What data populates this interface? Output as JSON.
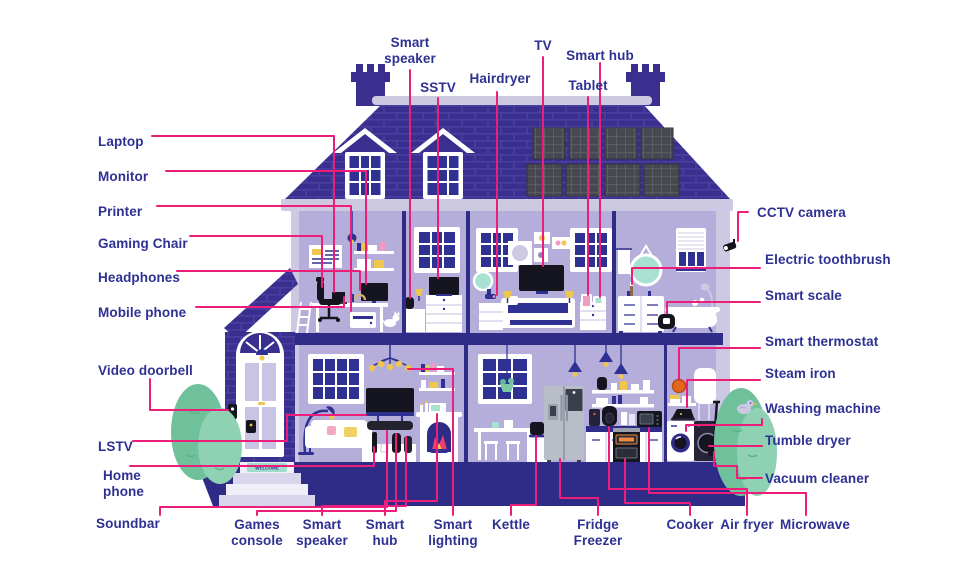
{
  "page": {
    "description": "Cutaway illustration of a smart home with labelled connected devices"
  },
  "colors": {
    "label_text": "#2e3192",
    "leader_line": "#ec1e79",
    "roof_purple": "#3a2f8e",
    "wall_lavender": "#b6aeda",
    "structure_indigo": "#2e2c86",
    "eaves_grey": "#cdc9e2",
    "bush_green_dark": "#6fc19c",
    "bush_green_light": "#8ed2b3",
    "accent_yellow": "#f0c64e",
    "accent_teal": "#a8e0d2",
    "accent_pink": "#f29bc1"
  },
  "house": {
    "welcome_mat": "WELCOME"
  },
  "labels": {
    "left": [
      "Laptop",
      "Monitor",
      "Printer",
      "Gaming Chair",
      "Headphones",
      "Mobile phone",
      "Video doorbell",
      "LSTV",
      "Home phone",
      "Soundbar"
    ],
    "top": [
      "Smart speaker",
      "SSTV",
      "Hairdryer",
      "TV",
      "Smart hub",
      "Tablet"
    ],
    "right": [
      "CCTV camera",
      "Electric toothbrush",
      "Smart scale",
      "Smart thermostat",
      "Steam iron",
      "Washing machine",
      "Tumble dryer",
      "Vacuum cleaner"
    ],
    "bottom": [
      "Games console",
      "Smart speaker",
      "Smart hub",
      "Smart lighting",
      "Kettle",
      "Fridge Freezer",
      "Cooker",
      "Air fryer",
      "Microwave"
    ]
  }
}
